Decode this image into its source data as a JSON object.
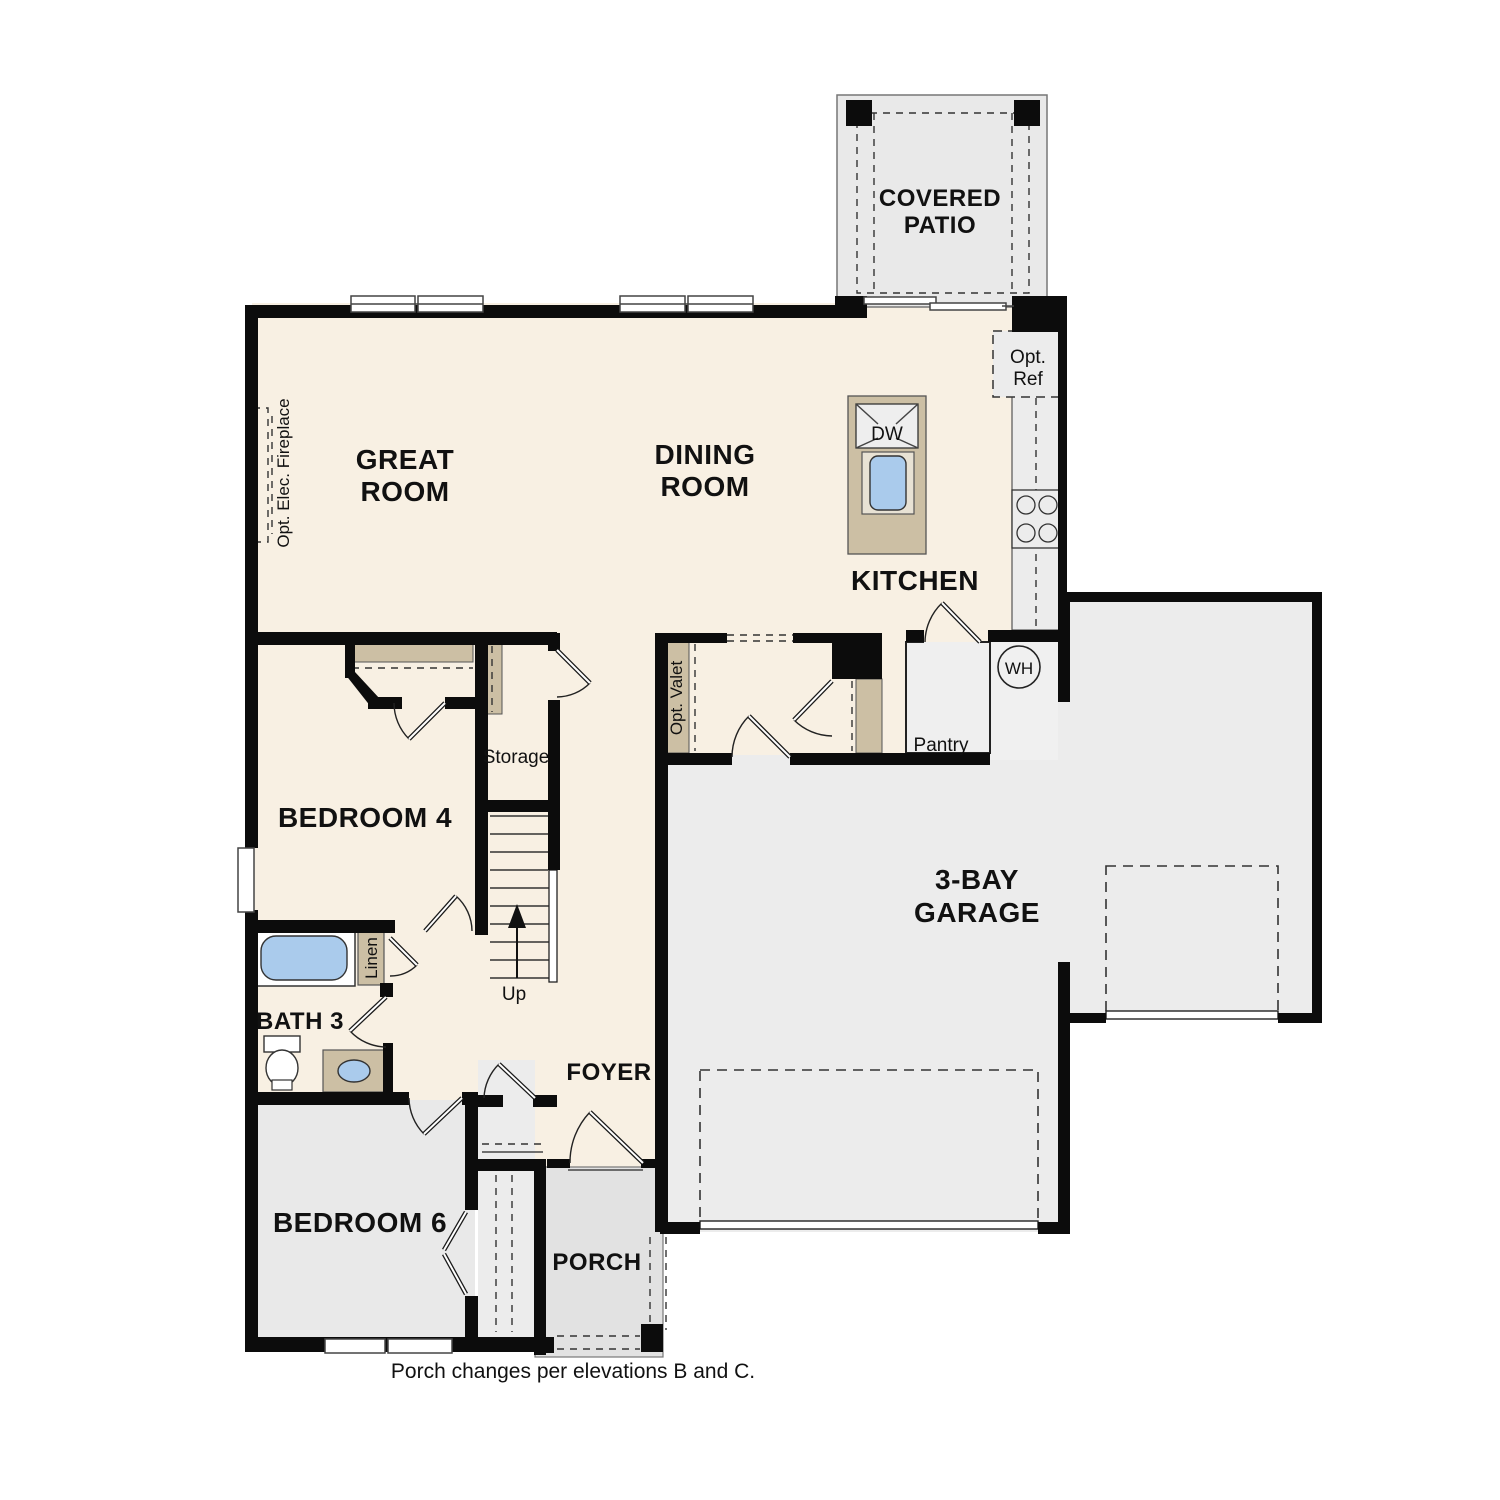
{
  "plan": {
    "rooms": {
      "covered_patio": {
        "line1": "COVERED",
        "line2": "PATIO"
      },
      "great_room": {
        "line1": "GREAT",
        "line2": "ROOM"
      },
      "dining_room": {
        "line1": "DINING",
        "line2": "ROOM"
      },
      "kitchen": {
        "label": "KITCHEN"
      },
      "bedroom4": {
        "label": "BEDROOM 4"
      },
      "bath3": {
        "label": "BATH 3"
      },
      "bedroom6": {
        "label": "BEDROOM 6"
      },
      "foyer": {
        "label": "FOYER"
      },
      "porch": {
        "label": "PORCH"
      },
      "garage": {
        "line1": "3-BAY",
        "line2": "GARAGE"
      },
      "storage": {
        "label": "Storage"
      },
      "pantry": {
        "label": "Pantry"
      }
    },
    "features": {
      "opt_ref": {
        "line1": "Opt.",
        "line2": "Ref"
      },
      "opt_valet": {
        "label": "Opt. Valet"
      },
      "opt_fireplace": {
        "label": "Opt. Elec. Fireplace"
      },
      "linen": {
        "label": "Linen"
      },
      "dishwasher": {
        "label": "DW"
      },
      "water_heater": {
        "label": "WH"
      },
      "stairs_up": {
        "label": "Up"
      }
    },
    "caption": "Porch changes per elevations B and C.",
    "colors": {
      "floor_main": "#f8f0e3",
      "floor_garage": "#ececec",
      "floor_patio": "#e9e9e9",
      "floor_porch": "#e2e2e2",
      "floor_bedroom6": "#e9e9e9",
      "cabinet_tan": "#ccbfa4",
      "fixture_blue": "#aacbec",
      "wall_black": "#0c0c0c"
    }
  }
}
